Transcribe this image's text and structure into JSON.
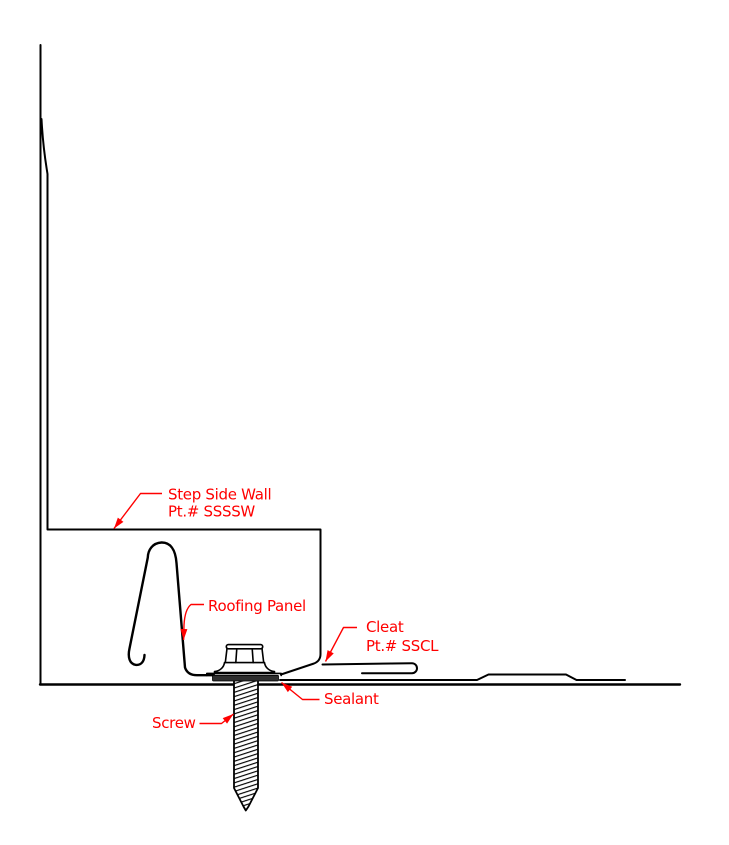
{
  "drawing_type": "construction-detail-diagram",
  "colors": {
    "line": "#000000",
    "annotation": "#ff0000",
    "sealant_fill": "#2e2e2e"
  },
  "annotations": {
    "step_side_wall": {
      "lines": [
        "Step Side Wall",
        "Pt.# SSSSW"
      ]
    },
    "roofing_panel": {
      "lines": [
        "Roofing Panel"
      ]
    },
    "cleat": {
      "lines": [
        "Cleat",
        "Pt.# SSCL"
      ]
    },
    "sealant": {
      "lines": [
        "Sealant"
      ]
    },
    "screw": {
      "lines": [
        "Screw"
      ]
    }
  }
}
